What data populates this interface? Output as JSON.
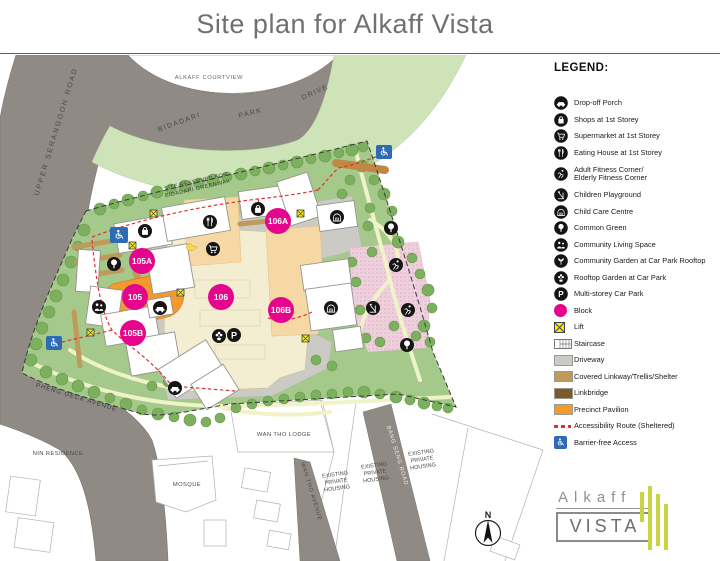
{
  "title": "Site plan for Alkaff Vista",
  "legend": {
    "title": "LEGEND:",
    "items": [
      {
        "icon": "drop-off-porch-icon",
        "label": "Drop-off Porch"
      },
      {
        "icon": "shops-icon",
        "label": "Shops at 1st Storey"
      },
      {
        "icon": "supermarket-icon",
        "label": "Supermarket at 1st Storey"
      },
      {
        "icon": "eating-house-icon",
        "label": "Eating House at 1st Storey"
      },
      {
        "icon": "adult-fitness-icon",
        "label": "Adult Fitness Corner/",
        "label2": "Elderly Fitness Corner"
      },
      {
        "icon": "children-playground-icon",
        "label": "Children Playground"
      },
      {
        "icon": "child-care-centre-icon",
        "label": "Child Care Centre"
      },
      {
        "icon": "common-green-icon",
        "label": "Common Green"
      },
      {
        "icon": "community-living-space-icon",
        "label": "Community Living Space"
      },
      {
        "icon": "community-garden-icon",
        "label": "Community Garden at Car Park Rooftop"
      },
      {
        "icon": "rooftop-garden-icon",
        "label": "Rooftop Garden at Car Park"
      },
      {
        "icon": "multi-storey-car-park-icon",
        "label": "Multi-storey Car Park"
      },
      {
        "icon": "block-icon",
        "label": "Block"
      },
      {
        "icon": "lift-icon",
        "label": "Lift"
      },
      {
        "icon": "staircase-icon",
        "label": "Staircase"
      },
      {
        "icon": "driveway-icon",
        "label": "Driveway"
      },
      {
        "icon": "covered-linkway-icon",
        "label": "Covered Linkway/Trellis/Shelter"
      },
      {
        "icon": "linkbridge-icon",
        "label": "Linkbridge"
      },
      {
        "icon": "precinct-pavilion-icon",
        "label": "Precinct Pavilion"
      },
      {
        "icon": "accessibility-route-icon",
        "label": "Accessibility Route (Sheltered)"
      },
      {
        "icon": "barrier-free-access-icon",
        "label": "Barrier-free Access"
      }
    ]
  },
  "map": {
    "road_labels": {
      "upper_serangoon": "UPPER SERANGOON ROAD",
      "bidadari": "BIDADARI",
      "park": "PARK",
      "drive": "DRIVE",
      "pheng_geck": "PHENG GECK AVENUE",
      "wan_tho_ave": "WAN THO AVENUE",
      "bang_seng": "BANG SENG ROAD"
    },
    "area_labels": {
      "alkaff_courtview": "ALKAFF COURTVIEW",
      "site_reserved_1": "SITE RESERVED FOR",
      "site_reserved_2": "BIDADARI GREENWAY",
      "nin_residence": "NIN RESIDENCE",
      "wan_tho_lodge": "WAN THO LODGE",
      "mosque": "MOSQUE",
      "existing": "EXISTING",
      "private": "PRIVATE",
      "housing": "HOUSING"
    },
    "blocks": {
      "b105": "105",
      "b105a": "105A",
      "b105b": "105B",
      "b106": "106",
      "b106a": "106A",
      "b106b": "106B"
    }
  },
  "compass": {
    "label": "N"
  },
  "logo": {
    "line1": "Alkaff",
    "line2": "VISTA"
  },
  "colors": {
    "block_magenta": "#e5058c",
    "road_gray": "#8f8a84",
    "site_green": "#a5c98a",
    "greenway_green": "#cfe3b8",
    "carpark_cream": "#f3edd2",
    "peach_zone": "#f6d8a4",
    "driveway_gray": "#cbcac4",
    "linkway_tan": "#bf9a5a",
    "linkbridge_brown": "#7d5a26",
    "precinct_orange": "#f49a2d",
    "lift_yellow": "#f6ea13",
    "accessibility_red": "#e03131",
    "barrier_free_blue": "#2d6cb5"
  }
}
